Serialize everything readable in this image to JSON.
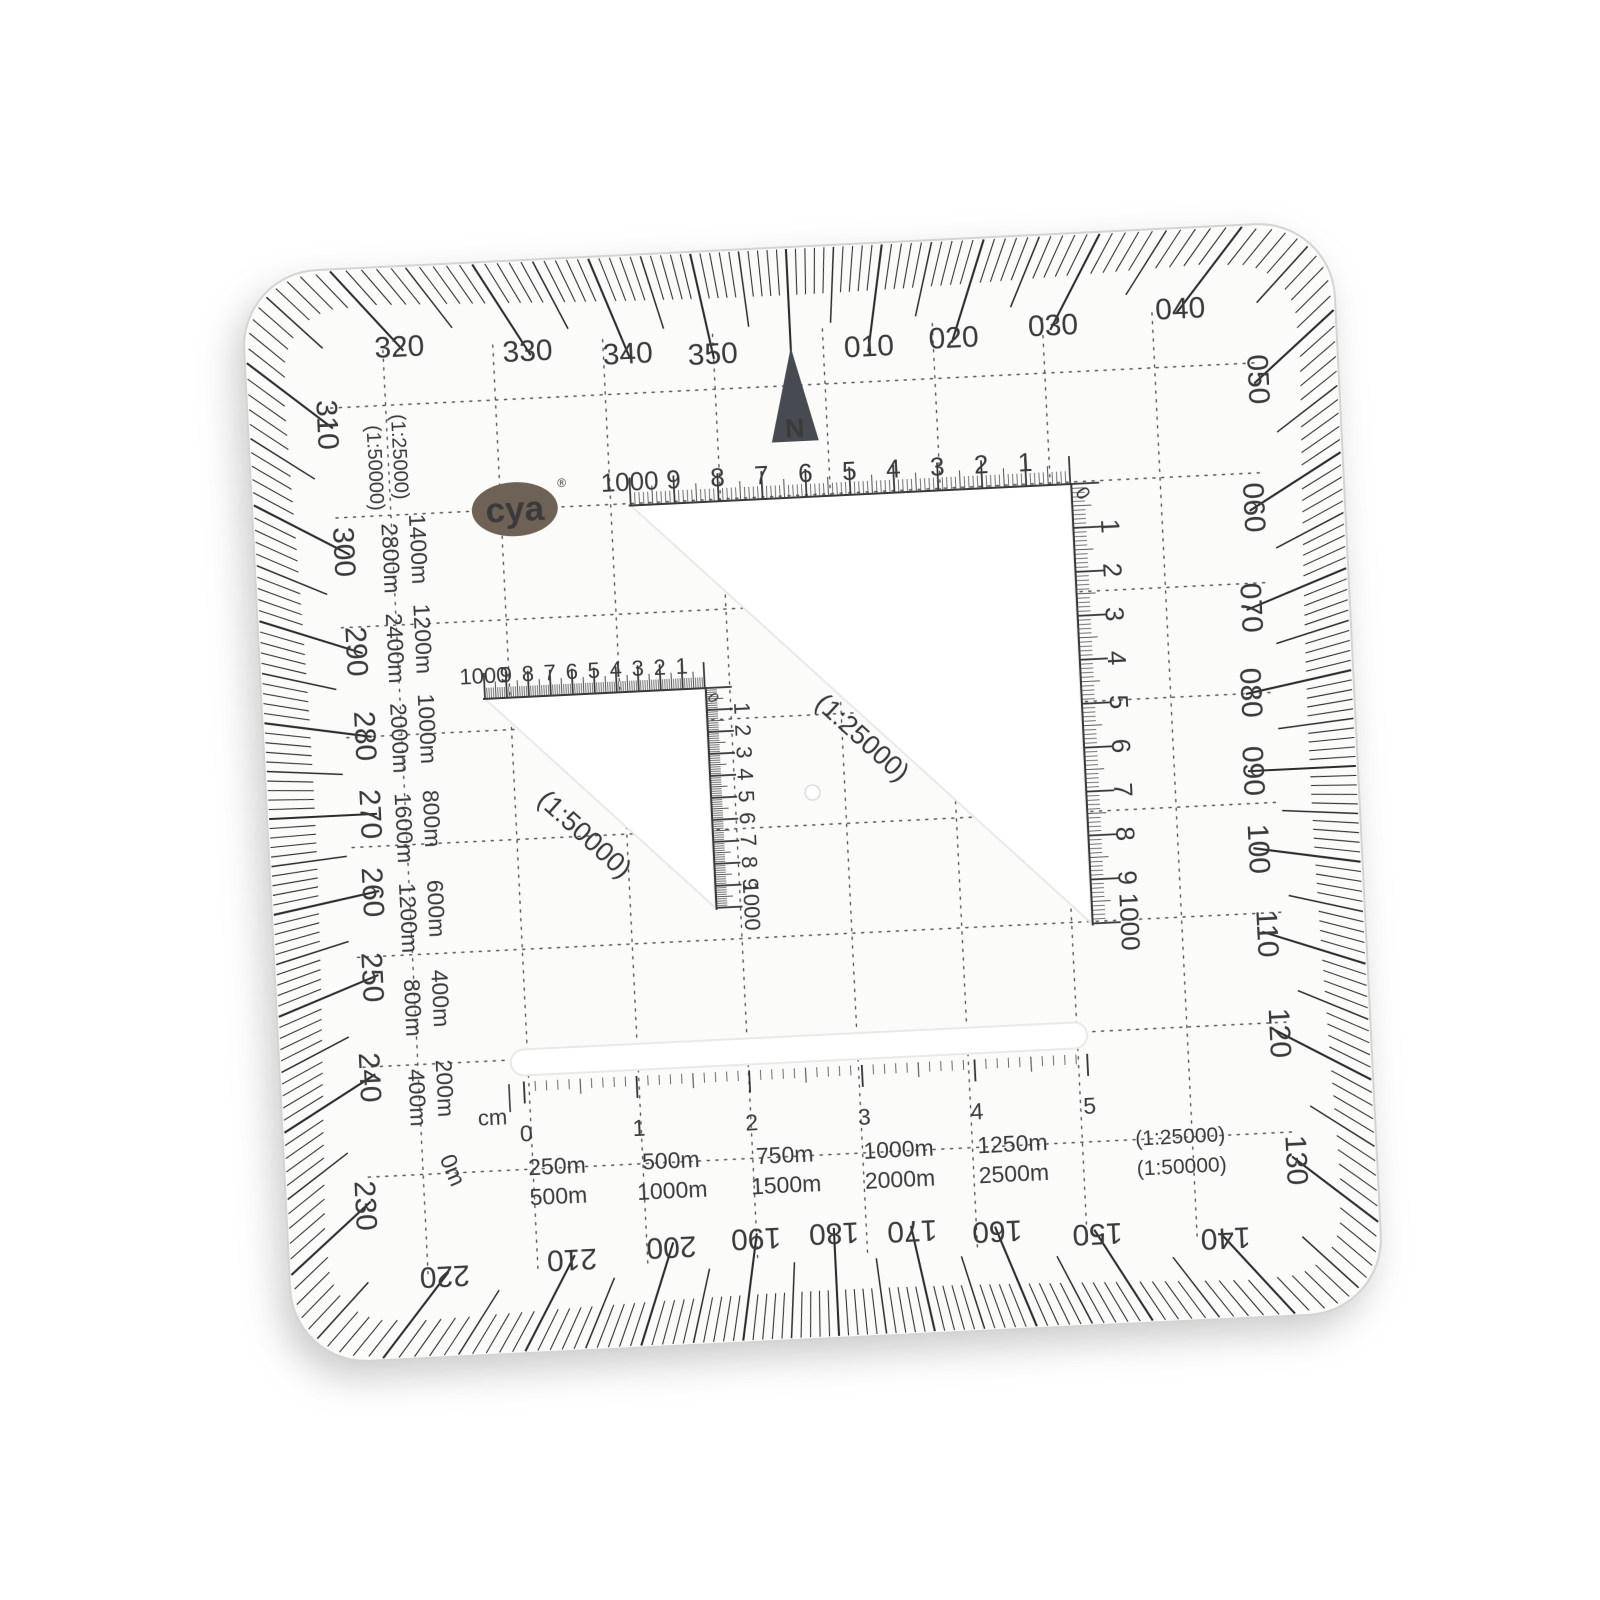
{
  "brand": {
    "name": "cya",
    "registered_mark": "®"
  },
  "north": {
    "letter": "N"
  },
  "colors": {
    "ink": "#3a3a3a",
    "hatch": "#2c2c2c",
    "logo": "#6e6156",
    "arrow": "#474b51"
  },
  "azimuth_labels": [
    {
      "deg": 10,
      "label": "010"
    },
    {
      "deg": 20,
      "label": "020"
    },
    {
      "deg": 30,
      "label": "030"
    },
    {
      "deg": 40,
      "label": "040"
    },
    {
      "deg": 50,
      "label": "050"
    },
    {
      "deg": 60,
      "label": "060"
    },
    {
      "deg": 70,
      "label": "070"
    },
    {
      "deg": 80,
      "label": "080"
    },
    {
      "deg": 90,
      "label": "090"
    },
    {
      "deg": 100,
      "label": "100"
    },
    {
      "deg": 110,
      "label": "110"
    },
    {
      "deg": 120,
      "label": "120"
    },
    {
      "deg": 130,
      "label": "130"
    },
    {
      "deg": 140,
      "label": "140"
    },
    {
      "deg": 150,
      "label": "150"
    },
    {
      "deg": 160,
      "label": "160"
    },
    {
      "deg": 170,
      "label": "170"
    },
    {
      "deg": 180,
      "label": "180"
    },
    {
      "deg": 190,
      "label": "190"
    },
    {
      "deg": 200,
      "label": "200"
    },
    {
      "deg": 210,
      "label": "210"
    },
    {
      "deg": 220,
      "label": "220"
    },
    {
      "deg": 230,
      "label": "230"
    },
    {
      "deg": 240,
      "label": "240"
    },
    {
      "deg": 250,
      "label": "250"
    },
    {
      "deg": 260,
      "label": "260"
    },
    {
      "deg": 270,
      "label": "270"
    },
    {
      "deg": 280,
      "label": "280"
    },
    {
      "deg": 290,
      "label": "290"
    },
    {
      "deg": 300,
      "label": "300"
    },
    {
      "deg": 310,
      "label": "310"
    },
    {
      "deg": 320,
      "label": "320"
    },
    {
      "deg": 330,
      "label": "330"
    },
    {
      "deg": 340,
      "label": "340"
    },
    {
      "deg": 350,
      "label": "350"
    }
  ],
  "scales": {
    "large_triangle": {
      "ratio_label": "(1:25000)",
      "corner_zero": "0",
      "top_numbers": [
        "1000",
        "9",
        "8",
        "7",
        "6",
        "5",
        "4",
        "3",
        "2",
        "1"
      ],
      "side_numbers": [
        "1",
        "2",
        "3",
        "4",
        "5",
        "6",
        "7",
        "8",
        "9",
        "1000"
      ]
    },
    "small_triangle": {
      "ratio_label": "(1:50000)",
      "corner_zero": "0",
      "top_numbers": [
        "1000",
        "9",
        "8",
        "7",
        "6",
        "5",
        "4",
        "3",
        "2",
        "1"
      ],
      "side_numbers": [
        "1",
        "2",
        "3",
        "4",
        "5",
        "6",
        "7",
        "8",
        "9",
        "1000"
      ]
    },
    "left_margin": {
      "header_25k": "(1:25000)",
      "header_50k": "(1:50000)",
      "labels_25k": [
        "1400m",
        "1200m",
        "1000m",
        "800m",
        "600m",
        "400m",
        "200m"
      ],
      "labels_50k": [
        "2800m",
        "2400m",
        "2000m",
        "1600m",
        "1200m",
        "800m",
        "400m"
      ],
      "zero_label": "0m"
    },
    "bottom_ruler": {
      "unit": "cm",
      "cm_numbers": [
        "0",
        "1",
        "2",
        "3",
        "4",
        "5"
      ],
      "labels_25k": [
        "250m",
        "500m",
        "750m",
        "1000m",
        "1250m"
      ],
      "labels_50k": [
        "500m",
        "1000m",
        "1500m",
        "2000m",
        "2500m"
      ],
      "ratio_25k": "(1:25000)",
      "ratio_50k": "(1:50000)"
    }
  }
}
